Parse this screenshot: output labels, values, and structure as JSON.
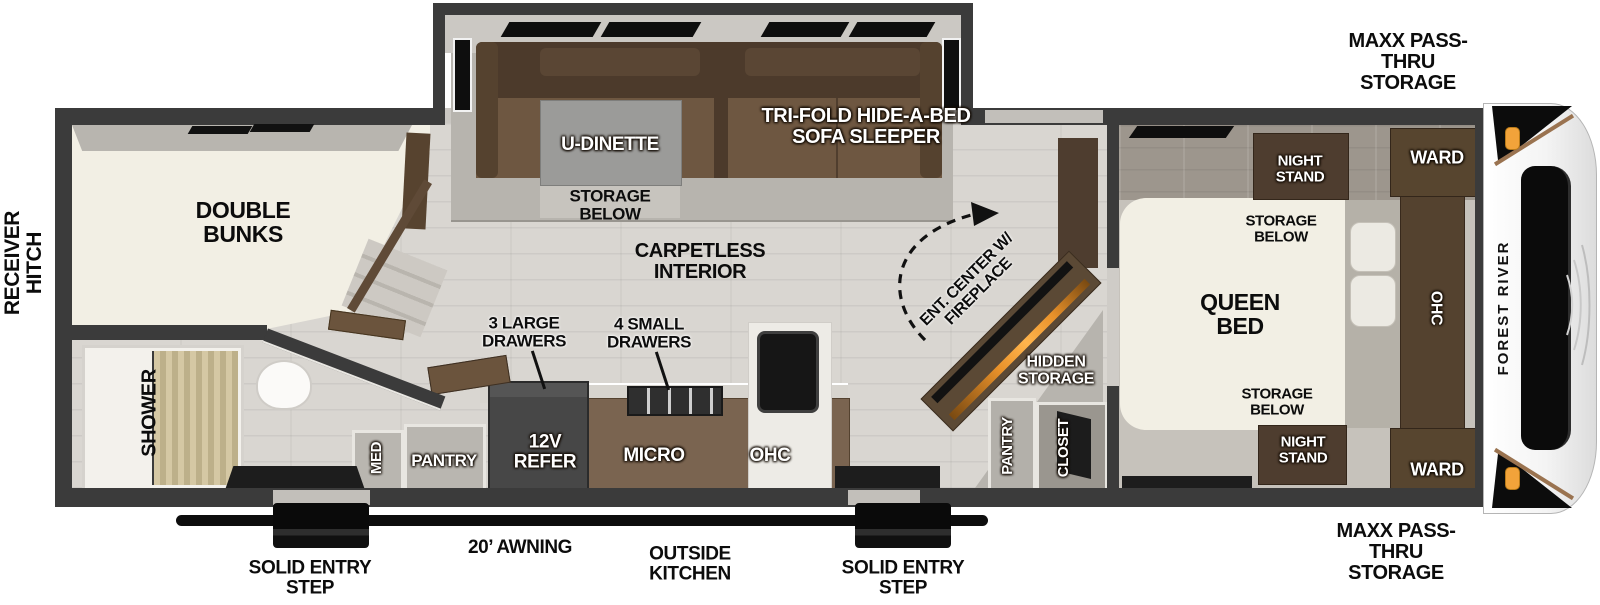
{
  "brand": {
    "logo_text": "FOREST RIVER"
  },
  "exterior": {
    "receiver_hitch": "RECEIVER HITCH",
    "maxx_pass_thru_top": "MAXX PASS-THRU STORAGE",
    "maxx_pass_thru_bottom": "MAXX PASS-THRU STORAGE",
    "awning": "20’ AWNING",
    "outside_kitchen": "OUTSIDE KITCHEN",
    "entry_step_left": "SOLID ENTRY STEP",
    "entry_step_right": "SOLID ENTRY STEP"
  },
  "bunk_room": {
    "bunks": "DOUBLE BUNKS"
  },
  "bathroom": {
    "shower": "SHOWER",
    "med_cabinet": "MED",
    "pantry": "PANTRY"
  },
  "kitchen": {
    "drawers_large": "3 LARGE DRAWERS",
    "drawers_small": "4 SMALL DRAWERS",
    "refrigerator": "12V REFER",
    "microwave": "MICRO",
    "overhead_cabinet": "OHC"
  },
  "living": {
    "dinette": "U-DINETTE",
    "dinette_storage": "STORAGE BELOW",
    "sofa": "TRI-FOLD HIDE-A-BED SOFA SLEEPER",
    "flooring": "CARPETLESS INTERIOR",
    "entertainment": "ENT. CENTER W/ FIREPLACE",
    "hidden_storage": "HIDDEN STORAGE",
    "pantry": "PANTRY",
    "closet": "CLOSET"
  },
  "bedroom": {
    "bed": "QUEEN BED",
    "night_stand_front": "NIGHT STAND",
    "storage_front": "STORAGE BELOW",
    "storage_rear": "STORAGE BELOW",
    "night_stand_rear": "NIGHT STAND",
    "ward_front": "WARD",
    "ward_rear": "WARD",
    "overhead_cabinet": "OHC"
  },
  "colors": {
    "wall": "#3b3b3b",
    "furniture_walnut": "#4e3d2f",
    "sofa_seat": "#6e5741",
    "fireplace_accent": "#e8912a",
    "clearance_light": "#f2a33a",
    "mattress_cream": "#f2efe4",
    "floor_wood": "#d9d6d1"
  }
}
